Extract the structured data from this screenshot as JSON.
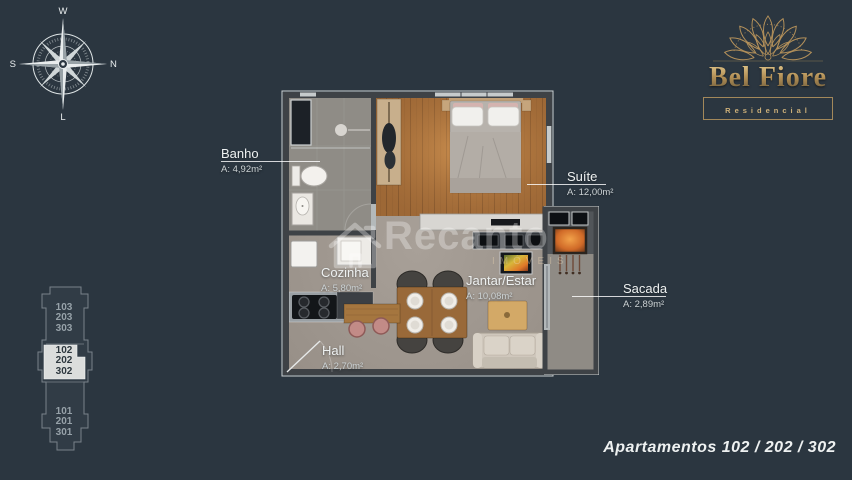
{
  "colors": {
    "background": "#2b3640",
    "brand_gold": "#c3a26b",
    "highlight_box": "#dbdddc",
    "wall": "#3e4246",
    "wood_floor": "#a9743f"
  },
  "compass": {
    "top": "W",
    "right": "N",
    "left": "S",
    "bottom": "L"
  },
  "logo": {
    "title": "Bel Fiore",
    "subtitle": "Residencial"
  },
  "building_diagram": {
    "sections": [
      {
        "units": [
          "103",
          "203",
          "303"
        ],
        "highlighted": false
      },
      {
        "units": [
          "102",
          "202",
          "302"
        ],
        "highlighted": true
      },
      {
        "units": [
          "101",
          "201",
          "301"
        ],
        "highlighted": false
      }
    ]
  },
  "floor_plan": {
    "rooms": [
      {
        "name": "Banho",
        "area": "A: 4,92m²"
      },
      {
        "name": "Suíte",
        "area": "A: 12,00m²"
      },
      {
        "name": "Cozinha",
        "area": "A: 5,80m²"
      },
      {
        "name": "Jantar/Estar",
        "area": "A: 10,08m²"
      },
      {
        "name": "Hall",
        "area": "A: 2,70m²"
      },
      {
        "name": "Sacada",
        "area": "A: 2,89m²"
      }
    ]
  },
  "watermark": {
    "brand": "Recanto",
    "subtitle": "IMÓVEIS"
  },
  "footer": {
    "caption": "Apartamentos 102 / 202 / 302"
  }
}
